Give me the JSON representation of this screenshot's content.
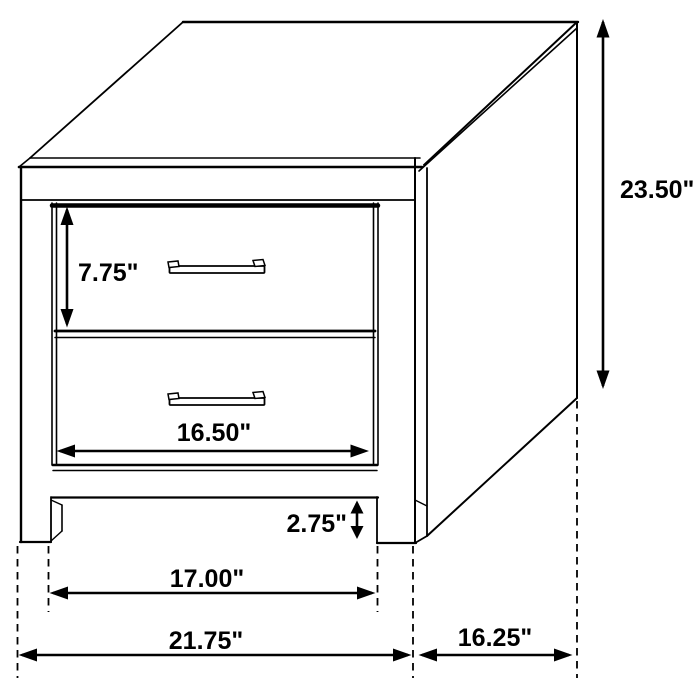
{
  "diagram": {
    "type": "furniture-dimension-diagram",
    "subject": "Two-drawer nightstand line drawing with dimension callouts",
    "colors": {
      "line": "#000000",
      "background": "#ffffff"
    },
    "dimensions": {
      "overall_height": "23.50\"",
      "top_drawer_height": "7.75\"",
      "drawer_opening_width": "16.50\"",
      "base_clearance_height": "2.75\"",
      "inner_leg_span": "17.00\"",
      "overall_width": "21.75\"",
      "side_depth": "16.25\""
    }
  }
}
